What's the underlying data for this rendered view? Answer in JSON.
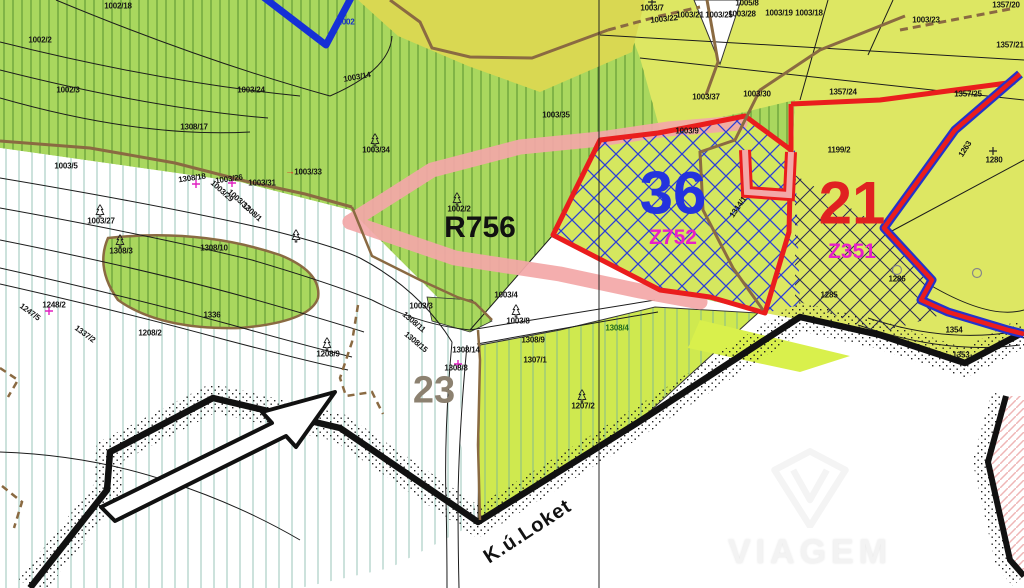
{
  "map": {
    "cadastral_area": {
      "label": "K.ú.Loket"
    },
    "watermark": {
      "logo": "viagem-diamond-logo",
      "text": "VIAGEM"
    },
    "zones": {
      "corridor": {
        "label": "R756",
        "band_color": "#f3a8a8"
      },
      "z36": {
        "number": "36",
        "code": "Z752",
        "number_color": "#2433dd",
        "code_color": "#e81ec8",
        "outline_color": "#ea1d1d",
        "hatch_color": "#2b3ed8"
      },
      "z21": {
        "number": "21",
        "code": "Z351",
        "number_color": "#e02121",
        "code_color": "#e81ec8",
        "hatch_color": "#2a2a55"
      },
      "z23": {
        "label": "23",
        "label_color": "#8c8170"
      }
    },
    "colors": {
      "forest_green": "#a9d75e",
      "meadow_lime": "#dde763",
      "field_yellow": "#d9d852",
      "corridor_pink": "#f3a8a8",
      "boundary_black": "#111111",
      "boundary_red": "#ea1d1d",
      "boundary_blue": "#2233cc",
      "stream_blue": "#1530d6",
      "path_brown": "#8a6a42"
    },
    "labels": [
      {
        "text": "1002/18",
        "x": 118,
        "y": 6
      },
      {
        "text": "1002/2",
        "x": 40,
        "y": 40
      },
      {
        "text": "1002/3",
        "x": 68,
        "y": 90
      },
      {
        "text": "1308/17",
        "x": 194,
        "y": 127
      },
      {
        "text": "1003/14",
        "x": 357,
        "y": 77,
        "rot": -10
      },
      {
        "text": "1002",
        "x": 346,
        "y": 22,
        "kind": "blue"
      },
      {
        "text": "1003/24",
        "x": 251,
        "y": 90
      },
      {
        "text": "1003/5",
        "x": 66,
        "y": 166
      },
      {
        "text": "1308/18",
        "x": 192,
        "y": 178,
        "rot": -8
      },
      {
        "text": "1003/26",
        "x": 229,
        "y": 179,
        "rot": -8
      },
      {
        "text": "1003/31",
        "x": 262,
        "y": 183
      },
      {
        "text": "1003/33",
        "x": 308,
        "y": 172
      },
      {
        "text": "→",
        "x": 290,
        "y": 172,
        "kind": "redmark"
      },
      {
        "text": "1003/34",
        "x": 376,
        "y": 150
      },
      {
        "text": "1003/35",
        "x": 556,
        "y": 115
      },
      {
        "text": "1003/7",
        "x": 652,
        "y": 8
      },
      {
        "text": "1003/22",
        "x": 664,
        "y": 19,
        "rot": -6
      },
      {
        "text": "1003/21",
        "x": 690,
        "y": 15
      },
      {
        "text": "1003/25",
        "x": 719,
        "y": 15
      },
      {
        "text": "1003/28",
        "x": 742,
        "y": 14
      },
      {
        "text": "1003/19",
        "x": 779,
        "y": 13
      },
      {
        "text": "1003/18",
        "x": 809,
        "y": 13
      },
      {
        "text": "1005/8",
        "x": 747,
        "y": 3
      },
      {
        "text": "1003/23",
        "x": 926,
        "y": 20
      },
      {
        "text": "1357/20",
        "x": 1006,
        "y": 5
      },
      {
        "text": "1357/21",
        "x": 1010,
        "y": 45
      },
      {
        "text": "1357/25",
        "x": 968,
        "y": 94
      },
      {
        "text": "1357/24",
        "x": 843,
        "y": 92
      },
      {
        "text": "1003/30",
        "x": 757,
        "y": 94
      },
      {
        "text": "1003/37",
        "x": 706,
        "y": 97
      },
      {
        "text": "1003/9",
        "x": 687,
        "y": 131
      },
      {
        "text": "1199/2",
        "x": 839,
        "y": 150
      },
      {
        "text": "1263",
        "x": 965,
        "y": 149,
        "rot": -57
      },
      {
        "text": "1280",
        "x": 994,
        "y": 160
      },
      {
        "text": "1286",
        "x": 897,
        "y": 279
      },
      {
        "text": "1285",
        "x": 829,
        "y": 295
      },
      {
        "text": "1314/1",
        "x": 738,
        "y": 207,
        "rot": -55
      },
      {
        "text": "1002/2",
        "x": 459,
        "y": 209
      },
      {
        "text": "1003/4",
        "x": 506,
        "y": 295
      },
      {
        "text": "1003/3",
        "x": 421,
        "y": 306
      },
      {
        "text": "1003/27",
        "x": 101,
        "y": 221
      },
      {
        "text": "1308/3",
        "x": 121,
        "y": 251
      },
      {
        "text": "1308/10",
        "x": 214,
        "y": 248
      },
      {
        "text": "1003/29",
        "x": 222,
        "y": 191,
        "rot": 42
      },
      {
        "text": "1003/32",
        "x": 239,
        "y": 200,
        "rot": 42
      },
      {
        "text": "1308/1",
        "x": 252,
        "y": 212,
        "rot": 42
      },
      {
        "text": "1248/2",
        "x": 54,
        "y": 305
      },
      {
        "text": "1247/5",
        "x": 30,
        "y": 312,
        "rot": 36
      },
      {
        "text": "1337/2",
        "x": 85,
        "y": 334,
        "rot": 36
      },
      {
        "text": "1208/2",
        "x": 150,
        "y": 333
      },
      {
        "text": "1336",
        "x": 212,
        "y": 315
      },
      {
        "text": "1208/9",
        "x": 328,
        "y": 354
      },
      {
        "text": "1308/11",
        "x": 414,
        "y": 322,
        "rot": 40
      },
      {
        "text": "1308/15",
        "x": 416,
        "y": 342,
        "rot": 40
      },
      {
        "text": "1308/9",
        "x": 533,
        "y": 340
      },
      {
        "text": "1308/14",
        "x": 466,
        "y": 350
      },
      {
        "text": "1308/8",
        "x": 456,
        "y": 368
      },
      {
        "text": "1307/1",
        "x": 535,
        "y": 360
      },
      {
        "text": "1003/8",
        "x": 518,
        "y": 321
      },
      {
        "text": "1308/4",
        "x": 617,
        "y": 328,
        "kind": "green"
      },
      {
        "text": "1207/2",
        "x": 583,
        "y": 406
      },
      {
        "text": "1354",
        "x": 954,
        "y": 330
      },
      {
        "text": "1353",
        "x": 961,
        "y": 355
      }
    ],
    "symbols": [
      {
        "type": "tree",
        "x": 100,
        "y": 211
      },
      {
        "type": "tree",
        "x": 120,
        "y": 241
      },
      {
        "type": "tree",
        "x": 375,
        "y": 140
      },
      {
        "type": "tree",
        "x": 457,
        "y": 199
      },
      {
        "type": "tree",
        "x": 516,
        "y": 311
      },
      {
        "type": "tree",
        "x": 327,
        "y": 344
      },
      {
        "type": "tree",
        "x": 582,
        "y": 396
      },
      {
        "type": "tree",
        "x": 296,
        "y": 236
      },
      {
        "type": "cross-magenta",
        "x": 196,
        "y": 184
      },
      {
        "type": "cross-magenta",
        "x": 232,
        "y": 183
      },
      {
        "type": "cross-magenta",
        "x": 49,
        "y": 311
      },
      {
        "type": "cross-magenta",
        "x": 458,
        "y": 364
      },
      {
        "type": "cross-black",
        "x": 993,
        "y": 151
      },
      {
        "type": "cross-black",
        "x": 652,
        "y": 2
      },
      {
        "type": "circle",
        "x": 897,
        "y": 270
      },
      {
        "type": "circle",
        "x": 977,
        "y": 273
      }
    ]
  }
}
